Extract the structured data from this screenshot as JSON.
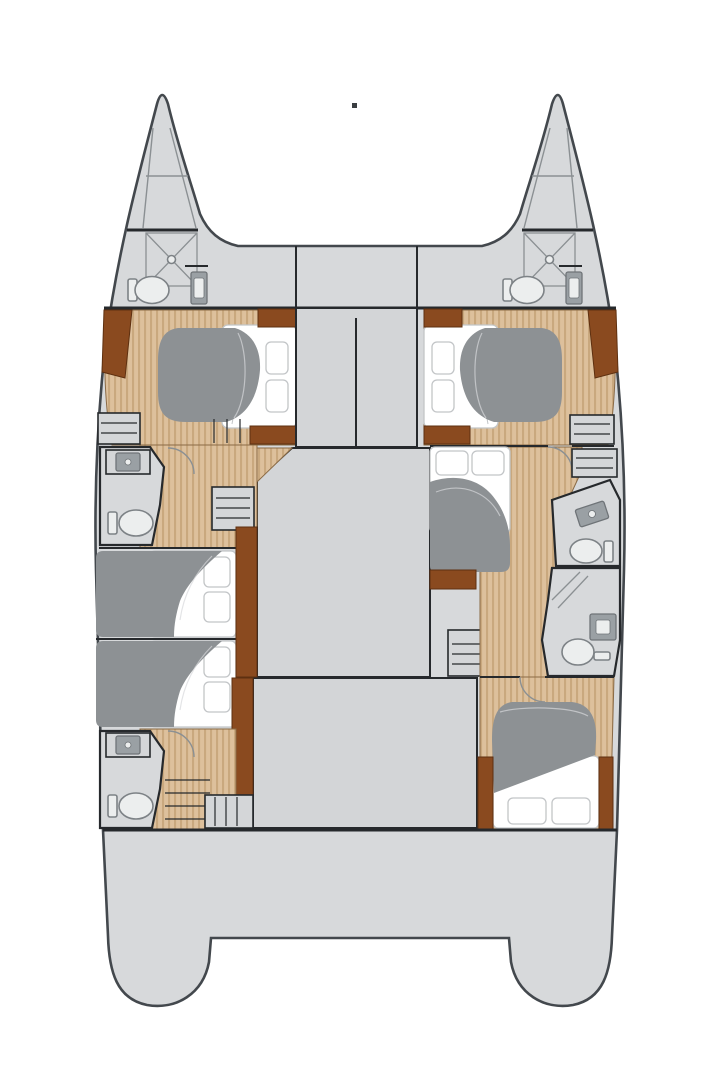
{
  "title": "Catamaran interior layout floor plan",
  "diagram_type": "yacht-floorplan",
  "colors": {
    "background": "#ffffff",
    "deck": "#d7d9db",
    "deckShade": "#d3d5d7",
    "outline": "#43484d",
    "wall": "#26292c",
    "thinLine": "#8b9093",
    "woodBase": "#ddc09c",
    "woodStripe": "#c9a87e",
    "woodEdge": "#8a6a45",
    "brown": "#8a4a1f",
    "brownDark": "#5e3010",
    "duvet": "#8d9194",
    "mattress": "#ffffff",
    "mattressLine": "#c2c5c7",
    "fixtureFill": "#eceeee",
    "fixtureStroke": "#7d8286",
    "sinkDark": "#9aa0a4",
    "sinkDarker": "#6f7478",
    "cabinet": "#d4d6d8",
    "dot": "#3a3e41"
  },
  "rooms": [
    {
      "name": "port-bow-locker"
    },
    {
      "name": "starboard-bow-locker"
    },
    {
      "name": "port-forward-head"
    },
    {
      "name": "starboard-forward-head"
    },
    {
      "name": "foredeck"
    },
    {
      "name": "port-forward-cabin"
    },
    {
      "name": "starboard-forward-cabin"
    },
    {
      "name": "saloon-deckhouse"
    },
    {
      "name": "port-mid-head"
    },
    {
      "name": "port-mid-cabin"
    },
    {
      "name": "port-aft-cabin"
    },
    {
      "name": "port-aft-head"
    },
    {
      "name": "starboard-mid-cabin"
    },
    {
      "name": "starboard-mid-head"
    },
    {
      "name": "starboard-aft-head"
    },
    {
      "name": "starboard-aft-cabin"
    },
    {
      "name": "cockpit"
    },
    {
      "name": "port-transom"
    },
    {
      "name": "starboard-transom"
    }
  ],
  "fixture_counts": {
    "double_beds": 6,
    "toilets": 6,
    "sinks": 6,
    "showers": 4
  }
}
